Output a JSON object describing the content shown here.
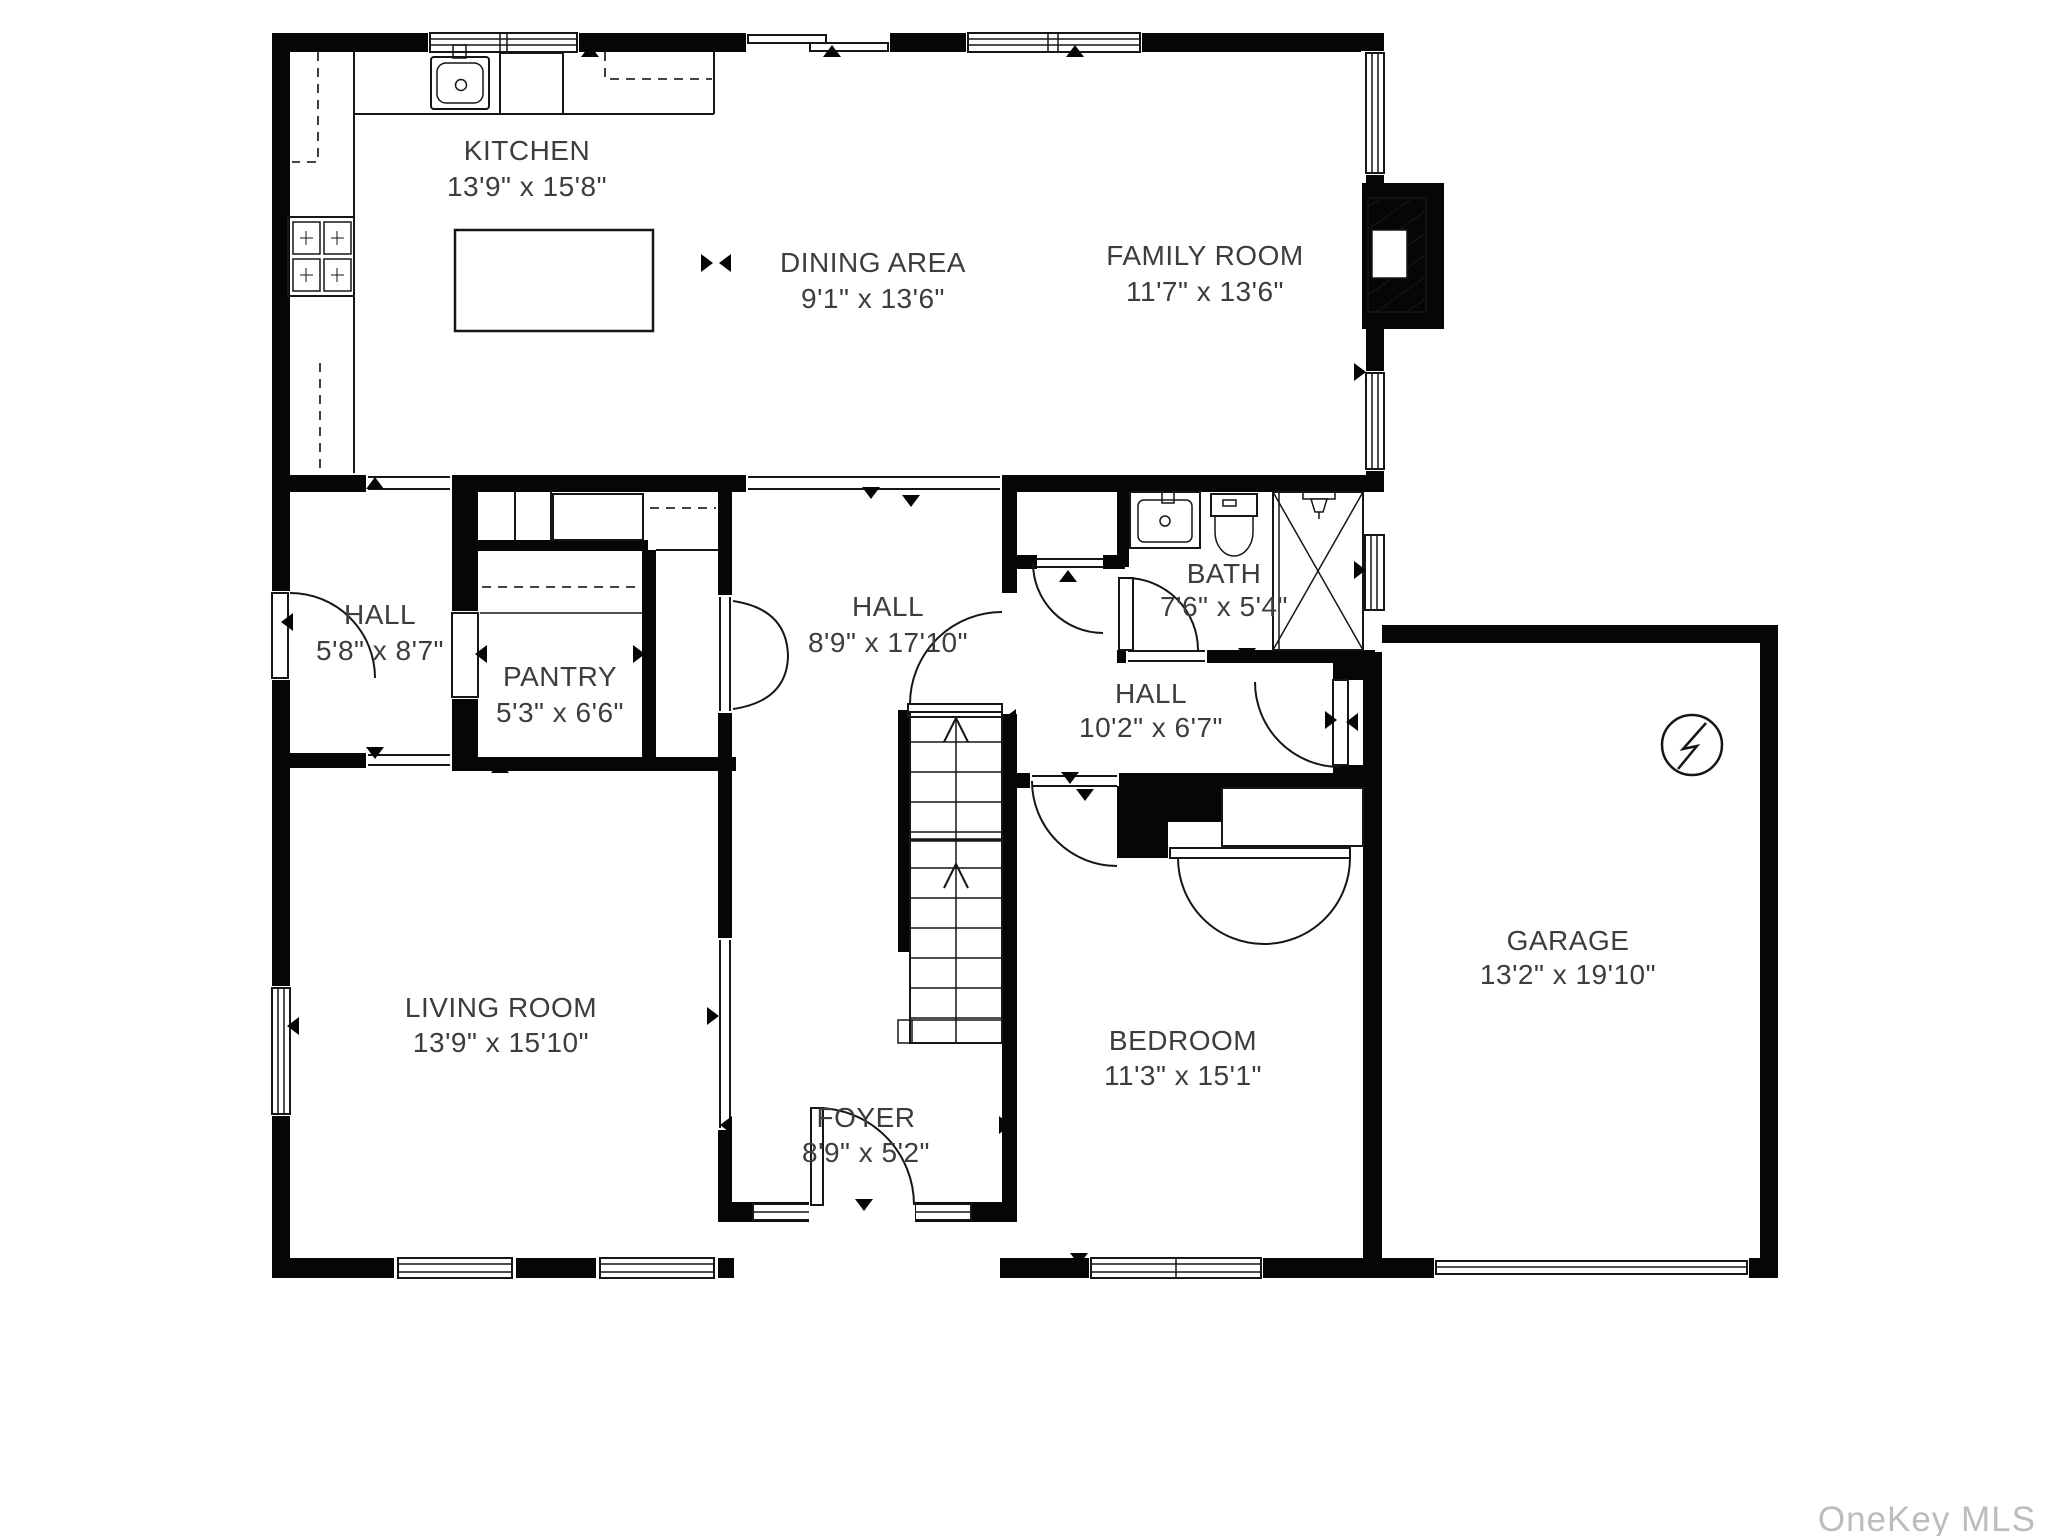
{
  "watermark": "OneKey MLS",
  "rooms": {
    "kitchen": {
      "name": "KITCHEN",
      "dims": "13'9\" x 15'8\""
    },
    "dining_area": {
      "name": "DINING AREA",
      "dims": "9'1\" x 13'6\""
    },
    "family_room": {
      "name": "FAMILY ROOM",
      "dims": "11'7\" x 13'6\""
    },
    "hall_left": {
      "name": "HALL",
      "dims": "5'8\" x 8'7\""
    },
    "pantry": {
      "name": "PANTRY",
      "dims": "5'3\" x 6'6\""
    },
    "hall_center": {
      "name": "HALL",
      "dims": "8'9\" x 17'10\""
    },
    "bath": {
      "name": "BATH",
      "dims": "7'6\" x 5'4\""
    },
    "hall_right": {
      "name": "HALL",
      "dims": "10'2\" x 6'7\""
    },
    "garage": {
      "name": "GARAGE",
      "dims": "13'2\" x 19'10\""
    },
    "living_room": {
      "name": "LIVING ROOM",
      "dims": "13'9\" x 15'10\""
    },
    "bedroom": {
      "name": "BEDROOM",
      "dims": "11'3\" x 15'1\""
    },
    "foyer": {
      "name": "FOYER",
      "dims": "8'9\" x 5'2\""
    }
  }
}
